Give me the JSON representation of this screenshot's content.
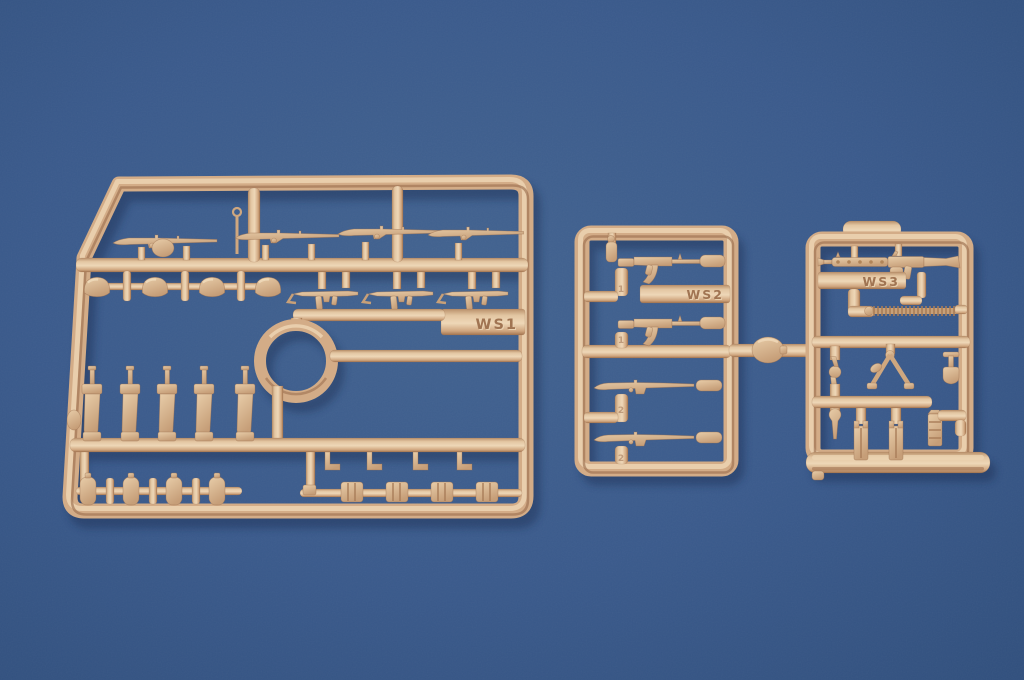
{
  "scene": {
    "type": "photograph",
    "subject": "Three tan injection-molded plastic model-kit sprues holding small weapon and field-equipment parts, laid on a plain blue backdrop",
    "background_color": "#3a5a8c",
    "plastic_base_color": "#d3ac87",
    "plastic_highlight_color": "#eed6b5",
    "plastic_shadow_color": "#9c7050"
  },
  "sprues": [
    {
      "position": "left",
      "label": "WS1",
      "contents": [
        "bolt-action rifles (x4)",
        "round shovel head",
        "helmets (x4)",
        "submachine guns (x3)",
        "carrying ring",
        "pistols (x5)",
        "canteens (x4)",
        "belt hooks (x4)",
        "ammunition pouches (x4)"
      ]
    },
    {
      "position": "center",
      "label": "WS2",
      "runner_numbers": [
        "1",
        "1",
        "2",
        "2"
      ],
      "contents": [
        "assault rifles (x2)",
        "semi-automatic rifles (x2)",
        "round flask on connector runner"
      ]
    },
    {
      "position": "right",
      "label": "WS3",
      "contents": [
        "machine gun",
        "ammunition belt",
        "bipod",
        "entrenching tool",
        "pliers",
        "wrench",
        "magazine pouches (x2)",
        "ammunition box"
      ]
    }
  ]
}
